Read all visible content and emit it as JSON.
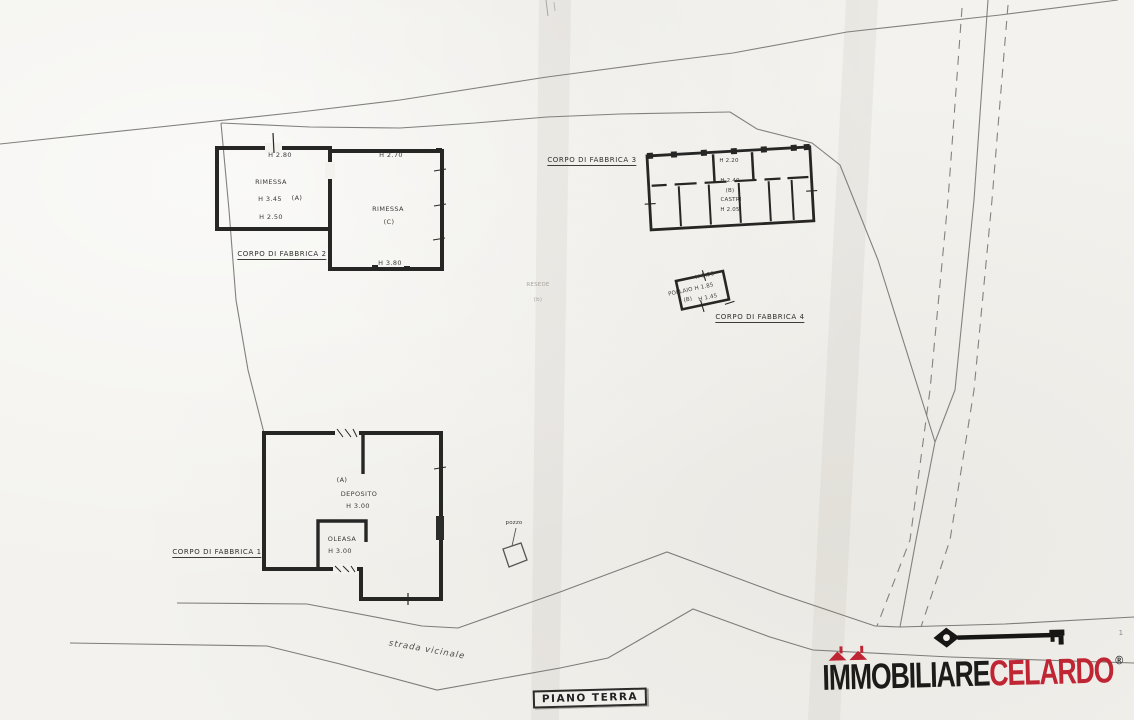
{
  "plan": {
    "stamp": "PIANO TERRA",
    "road_label": "strada vicinale",
    "resede_label": "RESEDE",
    "resede_sub": "(b)",
    "well_label": "pozzo",
    "page_mark": "1",
    "corpo1": {
      "title": "CORPO DI FABBRICA 1",
      "letter": "(A)",
      "room": "DEPOSITO",
      "room_height": "H 3.00",
      "room2": "OLEASA",
      "room2_height": "H 3.00"
    },
    "corpo2": {
      "title": "CORPO DI FABBRICA 2",
      "top_left_height": "H 2.80",
      "room1": "RIMESSA",
      "room1_height": "H 3.45",
      "room1_letter": "(A)",
      "bottom_left_height": "H 2.50",
      "top_right_height": "H 2.70",
      "room2": "RIMESSA",
      "room2_letter": "(C)",
      "bottom_right_height": "H 3.80"
    },
    "corpo3": {
      "title": "CORPO DI FABBRICA 3",
      "top_height": "H 2.20",
      "mid_height": "H 2.40",
      "letter": "(B)",
      "room": "CASTRI",
      "room_height": "H 2.05"
    },
    "corpo4": {
      "title": "CORPO DI FABBRICA 4",
      "top_height": "H 1.20",
      "room": "POLLAIO H 1.85",
      "letter": "(B)",
      "bottom_height": "H 1.45"
    }
  },
  "watermark": {
    "prefix": "I",
    "m1": "M",
    "m2": "M",
    "rest_black": "OBILIARE",
    "brand_red": "CELARDO",
    "registered": "®",
    "brand_black_color": "#1b1b19",
    "brand_red_color": "#bf2533"
  }
}
